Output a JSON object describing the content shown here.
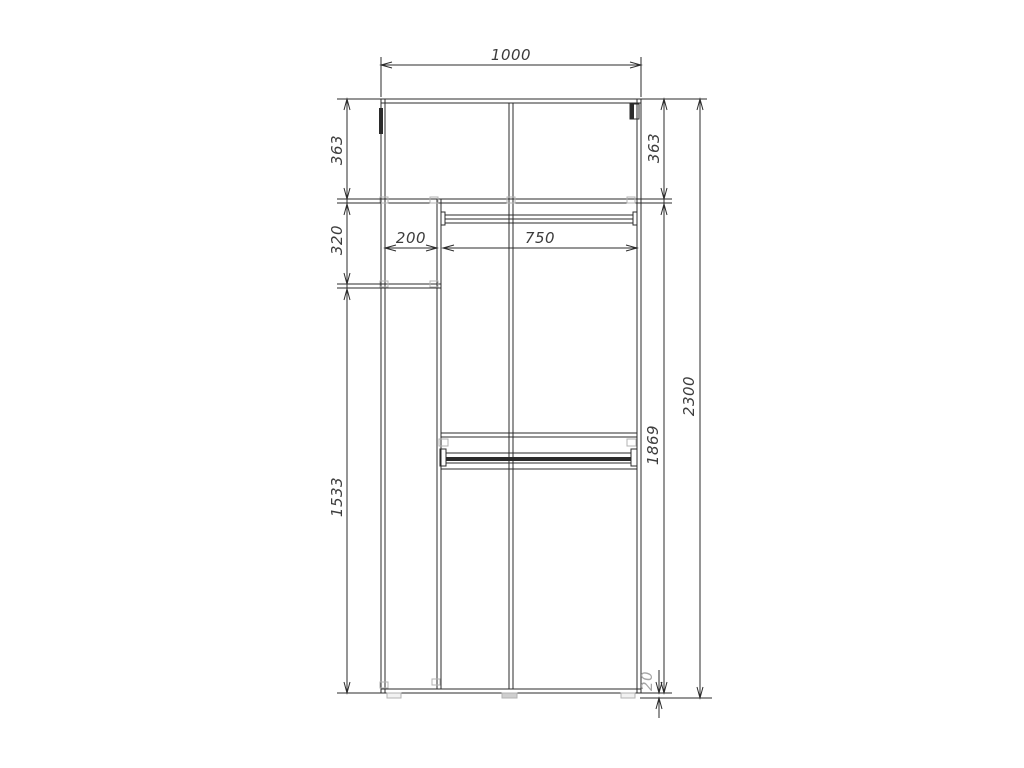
{
  "drawing": {
    "description": "Wardrobe front-view dimension drawing",
    "colors": {
      "line": "#2b2b2b",
      "fitting": "#b3b3b3",
      "foot_fill": "#f2f2f2",
      "foot_fill_center": "#cfcfcf",
      "dim_text": "#3c3c3c",
      "base_gap_text": "#a6a6a6",
      "background": "#ffffff"
    },
    "dimensions": {
      "overall_width": "1000",
      "top_left_height": "363",
      "top_right_height": "363",
      "left_niche_height": "320",
      "left_niche_width": "200",
      "rod_width": "750",
      "left_lower_height": "1533",
      "right_inner_height": "1869",
      "overall_height": "2300",
      "base_gap": "20"
    }
  }
}
